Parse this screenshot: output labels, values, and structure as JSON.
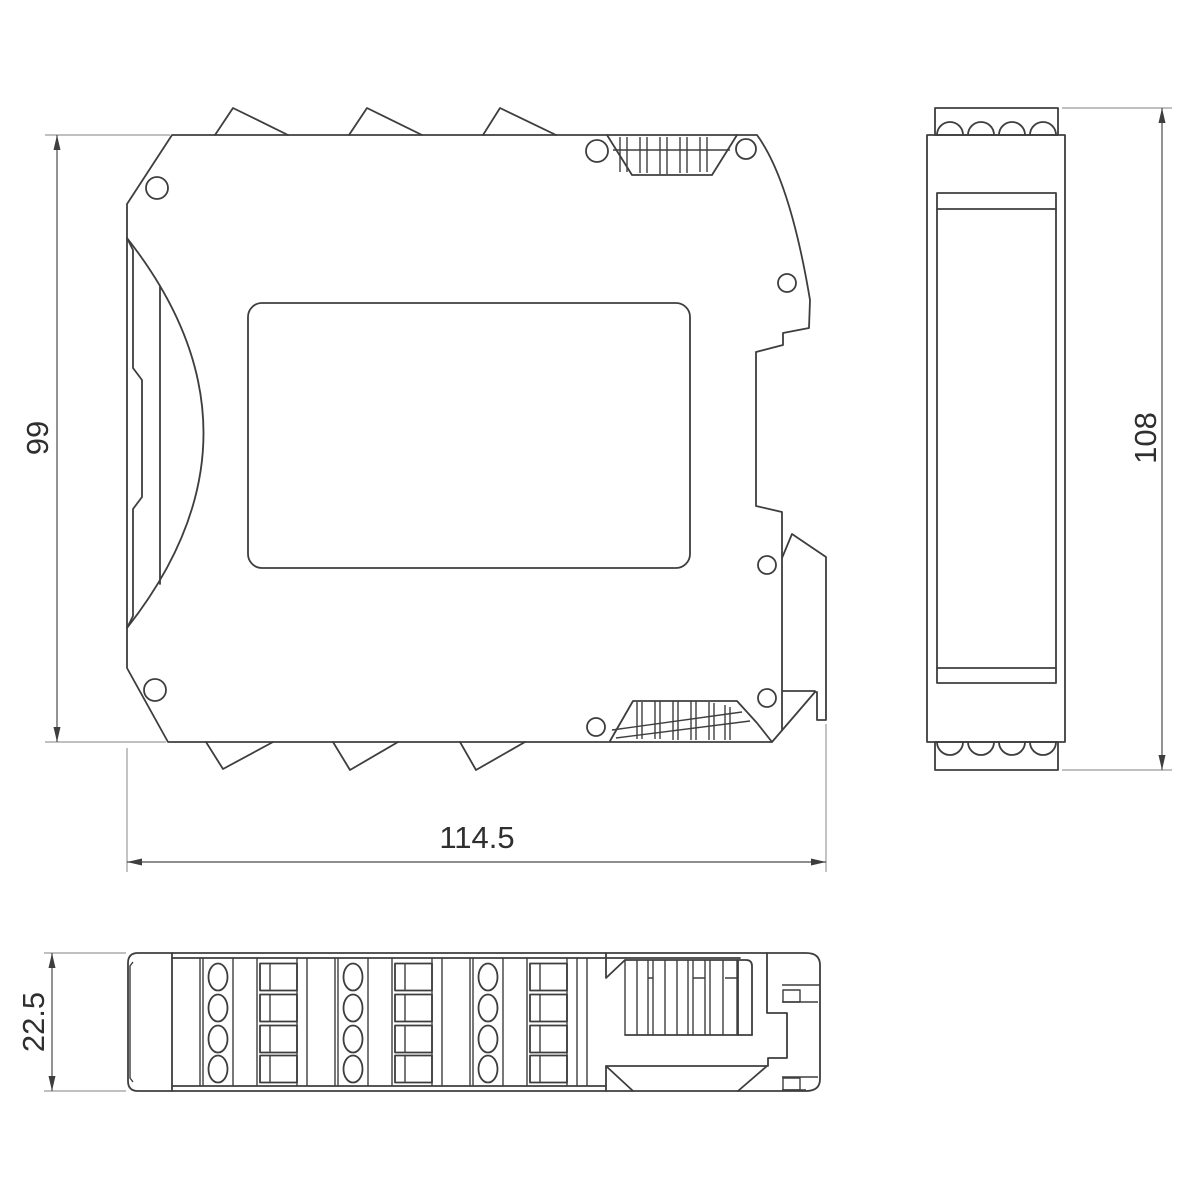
{
  "drawing": {
    "type": "technical-dimension-drawing",
    "background_color": "#ffffff",
    "line_color": "#3e3e3e",
    "dimension_line_color": "#4a4a4a",
    "extension_line_color": "#9b9b9b",
    "text_color": "#2f2f2f",
    "dimensions": {
      "side_height": {
        "label": "99"
      },
      "side_width": {
        "label": "114.5"
      },
      "front_height": {
        "label": "108"
      },
      "top_depth": {
        "label": "22.5"
      }
    }
  }
}
